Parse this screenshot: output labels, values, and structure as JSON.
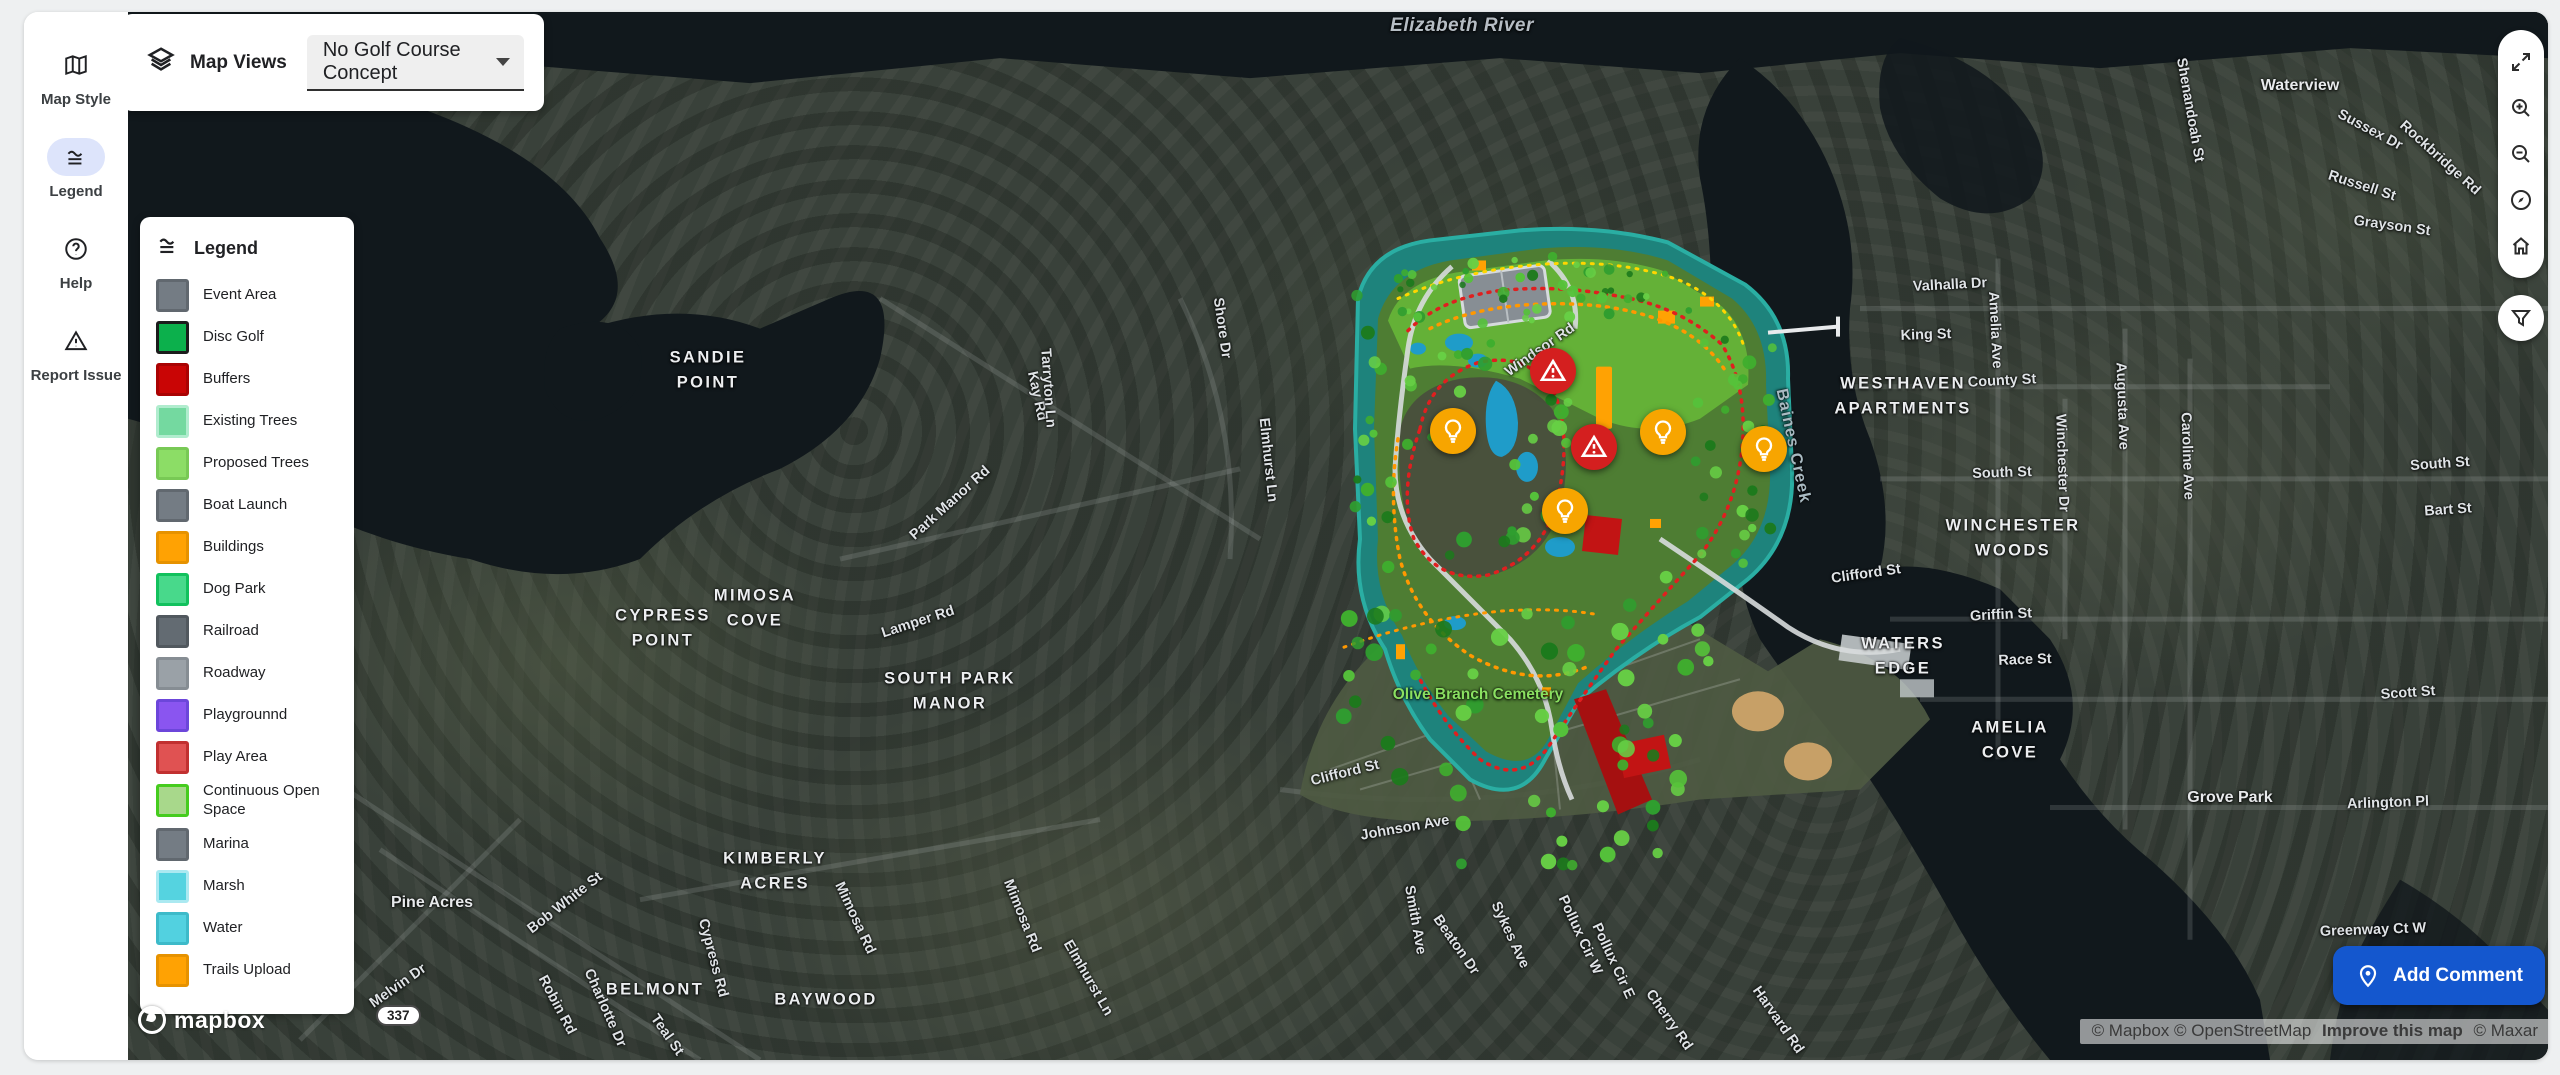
{
  "sidebar": {
    "items": [
      {
        "label": "Map Style",
        "icon": "map-icon",
        "active": false
      },
      {
        "label": "Legend",
        "icon": "legend-icon",
        "active": true
      },
      {
        "label": "Help",
        "icon": "help-icon",
        "active": false
      },
      {
        "label": "Report Issue",
        "icon": "warning-icon",
        "active": false
      }
    ]
  },
  "map_views": {
    "label": "Map Views",
    "selected": "No Golf Course Concept"
  },
  "legend": {
    "title": "Legend",
    "items": [
      {
        "label": "Event Area",
        "fill": "#747c84",
        "border": "#61686f"
      },
      {
        "label": "Disc Golf",
        "fill": "#0cb04c",
        "border": "#1c1c1c"
      },
      {
        "label": "Buffers",
        "fill": "#c90505",
        "border": "#a90303"
      },
      {
        "label": "Existing Trees",
        "fill": "#74d9a0",
        "border": "#b0ecce"
      },
      {
        "label": "Proposed Trees",
        "fill": "#8cdd66",
        "border": "#78c955"
      },
      {
        "label": "Boat Launch",
        "fill": "#747c84",
        "border": "#61686f"
      },
      {
        "label": "Buildings",
        "fill": "#ffa203",
        "border": "#e69200"
      },
      {
        "label": "Dog Park",
        "fill": "#48d98b",
        "border": "#12c15d"
      },
      {
        "label": "Railroad",
        "fill": "#636b72",
        "border": "#51585e"
      },
      {
        "label": "Roadway",
        "fill": "#9aa1a7",
        "border": "#868d93"
      },
      {
        "label": "Playgrounnd",
        "fill": "#8a55f0",
        "border": "#6c46da"
      },
      {
        "label": "Play Area",
        "fill": "#e05252",
        "border": "#c13030"
      },
      {
        "label": "Continuous Open Space",
        "fill": "#a8d88b",
        "border": "#45cc1e"
      },
      {
        "label": "Marina",
        "fill": "#747c84",
        "border": "#61686f"
      },
      {
        "label": "Marsh",
        "fill": "#55d3e0",
        "border": "#abe9f1"
      },
      {
        "label": "Water",
        "fill": "#52d1e0",
        "border": "#3dbac9"
      },
      {
        "label": "Trails Upload",
        "fill": "#ffa203",
        "border": "#e69200"
      }
    ]
  },
  "controls": [
    {
      "name": "fullscreen-button",
      "icon": "expand-icon"
    },
    {
      "name": "zoom-in-button",
      "icon": "zoom-in-icon"
    },
    {
      "name": "zoom-out-button",
      "icon": "zoom-out-icon"
    },
    {
      "name": "compass-button",
      "icon": "compass-icon"
    },
    {
      "name": "home-button",
      "icon": "home-icon"
    }
  ],
  "add_comment": {
    "label": "Add Comment"
  },
  "attribution": {
    "mapbox_osm": "© Mapbox © OpenStreetMap",
    "improve": "Improve this map",
    "maxar": "© Maxar"
  },
  "branding": {
    "wordmark": "mapbox"
  },
  "route_shield": {
    "text": "337"
  },
  "accent_colors": {
    "primary_blue": "#1457ce",
    "alert_red": "#d41f1f",
    "idea_amber": "#f7a500"
  },
  "markers": [
    {
      "type": "alert",
      "x": 1553,
      "y": 373
    },
    {
      "type": "alert",
      "x": 1594,
      "y": 449
    },
    {
      "type": "idea",
      "x": 1453,
      "y": 433
    },
    {
      "type": "idea",
      "x": 1663,
      "y": 434
    },
    {
      "type": "idea",
      "x": 1764,
      "y": 451
    },
    {
      "type": "idea",
      "x": 1565,
      "y": 513
    }
  ],
  "map_labels": [
    {
      "text": "Elizabeth River",
      "x": 1462,
      "y": 28,
      "type": "river"
    },
    {
      "text": "Baines Creek",
      "x": 1793,
      "y": 448,
      "type": "creek",
      "rot": 78
    },
    {
      "text": "Olive Branch Cemetery",
      "x": 1478,
      "y": 697,
      "type": "cemetery"
    },
    {
      "text": "SANDIE\nPOINT",
      "x": 708,
      "y": 372,
      "type": "area"
    },
    {
      "text": "CYPRESS\nPOINT",
      "x": 663,
      "y": 630,
      "type": "area"
    },
    {
      "text": "MIMOSA\nCOVE",
      "x": 755,
      "y": 610,
      "type": "area"
    },
    {
      "text": "SOUTH PARK\nMANOR",
      "x": 950,
      "y": 693,
      "type": "area"
    },
    {
      "text": "KIMBERLY\nACRES",
      "x": 775,
      "y": 873,
      "type": "area"
    },
    {
      "text": "BELMONT",
      "x": 655,
      "y": 992,
      "type": "area"
    },
    {
      "text": "BAYWOOD",
      "x": 826,
      "y": 1002,
      "type": "area"
    },
    {
      "text": "WESTHAVEN\nAPARTMENTS",
      "x": 1903,
      "y": 398,
      "type": "area"
    },
    {
      "text": "WINCHESTER\nWOODS",
      "x": 2013,
      "y": 540,
      "type": "area"
    },
    {
      "text": "WATERS\nEDGE",
      "x": 1903,
      "y": 658,
      "type": "area"
    },
    {
      "text": "AMELIA\nCOVE",
      "x": 2010,
      "y": 742,
      "type": "area"
    },
    {
      "text": "Pine Acres",
      "x": 432,
      "y": 905,
      "type": "place"
    },
    {
      "text": "Waterview",
      "x": 2300,
      "y": 88,
      "type": "place"
    },
    {
      "text": "Grove Park",
      "x": 2230,
      "y": 800,
      "type": "place"
    },
    {
      "text": "Windsor Rd",
      "x": 1540,
      "y": 352,
      "type": "street",
      "rot": -35
    },
    {
      "text": "Kay Rd",
      "x": 1037,
      "y": 398,
      "type": "street",
      "rot": 78
    },
    {
      "text": "Tarryton Ln",
      "x": 1048,
      "y": 390,
      "type": "street",
      "rot": 86
    },
    {
      "text": "Shore Dr",
      "x": 1222,
      "y": 330,
      "type": "street",
      "rot": 82
    },
    {
      "text": "Elmhurst Ln",
      "x": 1268,
      "y": 462,
      "type": "street",
      "rot": 84
    },
    {
      "text": "Park Manor Rd",
      "x": 950,
      "y": 505,
      "type": "street",
      "rot": -42
    },
    {
      "text": "Lamper Rd",
      "x": 918,
      "y": 624,
      "type": "street",
      "rot": -18
    },
    {
      "text": "Mimosa Rd",
      "x": 1022,
      "y": 918,
      "type": "street",
      "rot": 68
    },
    {
      "text": "Elmhurst Ln",
      "x": 1088,
      "y": 980,
      "type": "street",
      "rot": 60
    },
    {
      "text": "Bob White St",
      "x": 565,
      "y": 905,
      "type": "street",
      "rot": -38
    },
    {
      "text": "Melvin Dr",
      "x": 398,
      "y": 988,
      "type": "street",
      "rot": -35
    },
    {
      "text": "Robin Rd",
      "x": 557,
      "y": 1007,
      "type": "street",
      "rot": 62
    },
    {
      "text": "Charlotte Dr",
      "x": 605,
      "y": 1010,
      "type": "street",
      "rot": 66
    },
    {
      "text": "Teal St",
      "x": 667,
      "y": 1037,
      "type": "street",
      "rot": 55
    },
    {
      "text": "Cypress Rd",
      "x": 713,
      "y": 960,
      "type": "street",
      "rot": 75
    },
    {
      "text": "Mimosa Rd",
      "x": 855,
      "y": 920,
      "type": "street",
      "rot": 65
    },
    {
      "text": "Clifford St",
      "x": 1345,
      "y": 775,
      "type": "street",
      "rot": -14
    },
    {
      "text": "Clifford St",
      "x": 1866,
      "y": 576,
      "type": "street",
      "rot": -8
    },
    {
      "text": "Johnson Ave",
      "x": 1405,
      "y": 830,
      "type": "street",
      "rot": -10
    },
    {
      "text": "Valhalla Dr",
      "x": 1950,
      "y": 287,
      "type": "street",
      "rot": -3
    },
    {
      "text": "King St",
      "x": 1926,
      "y": 337,
      "type": "street",
      "rot": -2
    },
    {
      "text": "Amelia Ave",
      "x": 1995,
      "y": 332,
      "type": "street",
      "rot": 87
    },
    {
      "text": "County St",
      "x": 2002,
      "y": 383,
      "type": "street",
      "rot": -3
    },
    {
      "text": "Augusta Ave",
      "x": 2122,
      "y": 408,
      "type": "street",
      "rot": 88
    },
    {
      "text": "Winchester Dr",
      "x": 2062,
      "y": 465,
      "type": "street",
      "rot": 88
    },
    {
      "text": "Caroline Ave",
      "x": 2187,
      "y": 458,
      "type": "street",
      "rot": 88
    },
    {
      "text": "South St",
      "x": 2002,
      "y": 475,
      "type": "street",
      "rot": -2
    },
    {
      "text": "Griffin St",
      "x": 2001,
      "y": 617,
      "type": "street",
      "rot": -3
    },
    {
      "text": "Shenandoah St",
      "x": 2190,
      "y": 112,
      "type": "street",
      "rot": 80
    },
    {
      "text": "Sussex Dr",
      "x": 2370,
      "y": 132,
      "type": "street",
      "rot": 28
    },
    {
      "text": "Rockbridge Rd",
      "x": 2440,
      "y": 160,
      "type": "street",
      "rot": 42
    },
    {
      "text": "Russell St",
      "x": 2362,
      "y": 188,
      "type": "street",
      "rot": 18
    },
    {
      "text": "Grayson St",
      "x": 2392,
      "y": 228,
      "type": "street",
      "rot": 8
    },
    {
      "text": "Race St",
      "x": 2025,
      "y": 662,
      "type": "street",
      "rot": -2
    },
    {
      "text": "Scott St",
      "x": 2408,
      "y": 695,
      "type": "street",
      "rot": -4
    },
    {
      "text": "South St",
      "x": 2440,
      "y": 466,
      "type": "street",
      "rot": -4
    },
    {
      "text": "Bart St",
      "x": 2448,
      "y": 512,
      "type": "street",
      "rot": -4
    },
    {
      "text": "Arlington Pl",
      "x": 2388,
      "y": 805,
      "type": "street",
      "rot": -2
    },
    {
      "text": "Greenway Ct W",
      "x": 2373,
      "y": 932,
      "type": "street",
      "rot": -2
    },
    {
      "text": "Smith Ave",
      "x": 1415,
      "y": 922,
      "type": "street",
      "rot": 80
    },
    {
      "text": "Beaton Dr",
      "x": 1456,
      "y": 947,
      "type": "street",
      "rot": 55
    },
    {
      "text": "Sykes Ave",
      "x": 1510,
      "y": 937,
      "type": "street",
      "rot": 65
    },
    {
      "text": "Pollux Cir W",
      "x": 1580,
      "y": 937,
      "type": "street",
      "rot": 65
    },
    {
      "text": "Pollux Cir E",
      "x": 1613,
      "y": 963,
      "type": "street",
      "rot": 65
    },
    {
      "text": "Cherry Rd",
      "x": 1669,
      "y": 1022,
      "type": "street",
      "rot": 55
    },
    {
      "text": "Harvard Rd",
      "x": 1778,
      "y": 1022,
      "type": "street",
      "rot": 55
    }
  ]
}
